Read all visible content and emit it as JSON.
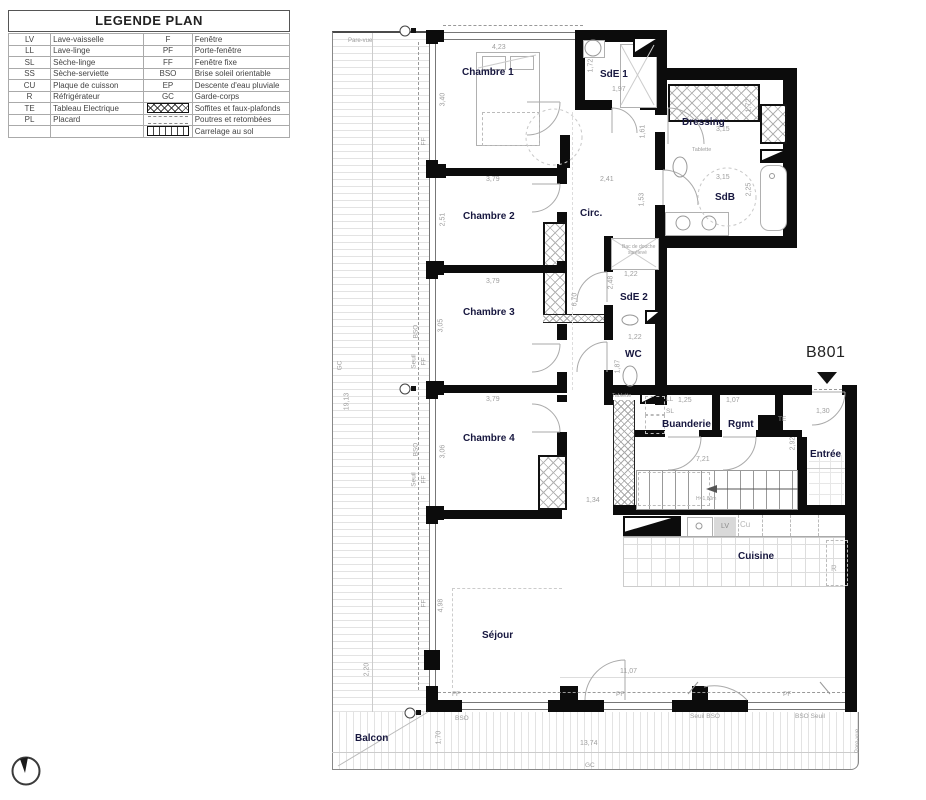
{
  "legend": {
    "title": "LEGENDE PLAN",
    "rows": [
      {
        "a": "LV",
        "al": "Lave-vaisselle",
        "b": "F",
        "bl": "Fenêtre"
      },
      {
        "a": "LL",
        "al": "Lave-linge",
        "b": "PF",
        "bl": "Porte-fenêtre"
      },
      {
        "a": "SL",
        "al": "Sèche-linge",
        "b": "FF",
        "bl": "Fenêtre fixe"
      },
      {
        "a": "SS",
        "al": "Sèche-serviette",
        "b": "BSO",
        "bl": "Brise soleil orientable"
      },
      {
        "a": "CU",
        "al": "Plaque de cuisson",
        "b": "EP",
        "bl": "Descente d'eau pluviale"
      },
      {
        "a": "R",
        "al": "Réfrigérateur",
        "b": "GC",
        "bl": "Garde-corps"
      },
      {
        "a": "TE",
        "al": "Tableau Electrique",
        "b": "",
        "bl": "Soffites et faux-plafonds"
      },
      {
        "a": "PL",
        "al": "Placard",
        "b": "",
        "bl": "Poutres et retombées"
      },
      {
        "a": "",
        "al": "",
        "b": "",
        "bl": "Carrelage au sol"
      }
    ]
  },
  "plan": {
    "unit": "B801",
    "rooms": {
      "chambre1": "Chambre 1",
      "sde1": "SdE 1",
      "dressing": "Dressing",
      "chambre2": "Chambre 2",
      "circ": "Circ.",
      "sdb": "SdB",
      "chambre3": "Chambre 3",
      "sde2": "SdE 2",
      "wc": "WC",
      "chambre4": "Chambre 4",
      "buanderie": "Buanderie",
      "rgmt": "Rgmt",
      "entree": "Entrée",
      "cuisine": "Cuisine",
      "sejour": "Séjour",
      "balcon": "Balcon"
    },
    "dims": {
      "ch1_width": "4,23",
      "ch1_height": "3,40",
      "ch1_bottom": "3,79",
      "sde1_h": "1,72",
      "sde1_w": "1,97",
      "sde1_right": "1,61",
      "circ_top": "2,41",
      "circ_right": "1,53",
      "dressing_w": "3,15",
      "dressing_h": "1,72",
      "sdb_w": "3,15",
      "sdb_h": "2,25",
      "ch2_h": "2,51",
      "ch2_bottom": "3,79",
      "corridor": "6,70",
      "ch3_h": "3,05",
      "ch3_bottom": "3,79",
      "sde2_w": "1,22",
      "sde2_h": "2,48",
      "wc_w": "1,22",
      "wc_h": "1,87",
      "ch4_h": "3,06",
      "ch4_right": "1,34",
      "buanderie_w": "1,25",
      "rgmt_w": "1,07",
      "hall": "7,21",
      "entree_h": "2,92",
      "entree_door": "1,30",
      "sejour_h": "4,98",
      "sejour_w": "11,07",
      "sejour_left": "2,20",
      "balcon_h": "1,70",
      "balcon_w": "13,74",
      "balcon_left_h": "19,13"
    },
    "tags": {
      "ff": "FF",
      "pf": "PF",
      "bso": "BSO",
      "seuil": "Seuil",
      "seuil_bso": "Seuil  BSO",
      "bso_seuil": "BSO  Seuil",
      "gc": "GC",
      "te": "TE",
      "ll": "LL",
      "sl": "SL",
      "lv": "LV",
      "cu": "Cu",
      "r": "R",
      "pare_vue": "Pare-vue",
      "tablette": "Tablette",
      "stairs_note": "H=1,80m",
      "shower_note1": "Bac de douche",
      "shower_note2": "surélevé"
    }
  }
}
